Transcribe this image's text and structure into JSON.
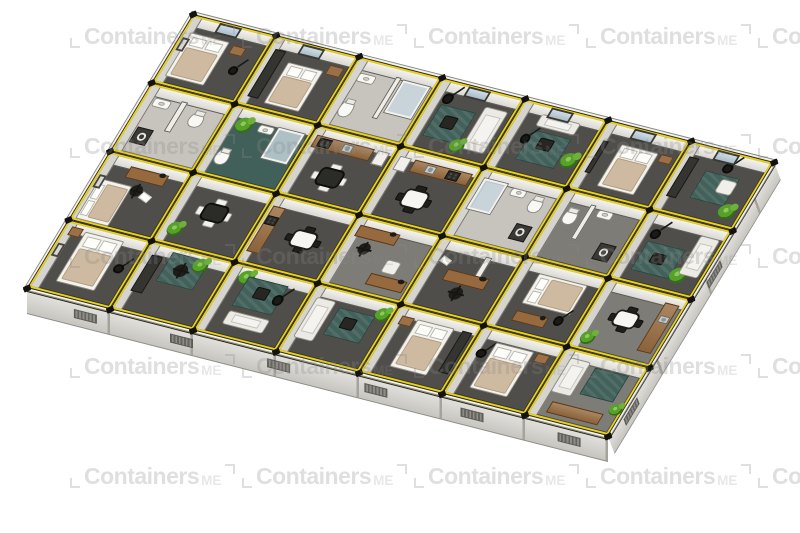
{
  "watermark": {
    "text": "Containers",
    "suffix": "ME"
  },
  "watermark_grid": {
    "cols": 5,
    "rows": 5,
    "x0": 70,
    "y0": 24,
    "dx": 172,
    "dy": 110
  },
  "palette": {
    "frame_yellow": "#e9d116",
    "edge_black": "#23221d",
    "wall_white": "#f2f1ed",
    "floor_dark": "#4f4e4a",
    "floor_mid": "#7e7c77",
    "floor_light": "#c7c4bd",
    "floor_teal": "#41605a",
    "wood": "#96693e",
    "plant_green": "#57a02c",
    "bed_beige": "#cdbaa0",
    "watermark_gray": "#e3e3e3"
  },
  "building": {
    "cols": 7,
    "rows": 4,
    "cell_w": 94,
    "cell_h": 80,
    "transform": "matrix(0.883,0.225,-0.519,0.856,193,14)",
    "facade_sw": {
      "transform": "matrix(0.883,0.225,0,1,27,288)",
      "w": 658,
      "h": 26,
      "vents": 6
    },
    "facade_se": {
      "transform": "matrix(0.519,-0.856,0.35,0.94,608,436)",
      "w": 320,
      "h": 19,
      "vents": 2
    },
    "cells": [
      {
        "col": 0,
        "row": 0,
        "floor": "dark",
        "window": true,
        "frame": true,
        "furn": [
          [
            "bed",
            10,
            24,
            46,
            64
          ],
          [
            "nightstand",
            62,
            26,
            16,
            13
          ],
          [
            "lamp",
            72,
            52,
            11,
            13
          ]
        ]
      },
      {
        "col": 1,
        "row": 0,
        "floor": "dark",
        "window": true,
        "furn": [
          [
            "wardrobe",
            8,
            18,
            13,
            68
          ],
          [
            "bed",
            30,
            30,
            42,
            60
          ],
          [
            "cabinet",
            76,
            20,
            17,
            14
          ]
        ]
      },
      {
        "col": 2,
        "row": 0,
        "floor": "light",
        "furn": [
          [
            "wall",
            52,
            14,
            7,
            60
          ],
          [
            "shower",
            62,
            16,
            32,
            46
          ],
          [
            "sink",
            12,
            20,
            20,
            12
          ],
          [
            "toilet",
            12,
            58,
            16,
            24
          ]
        ]
      },
      {
        "col": 3,
        "row": 0,
        "floor": "dark",
        "window": true,
        "furn": [
          [
            "rug",
            16,
            34,
            42,
            46
          ],
          [
            "sofa",
            64,
            22,
            28,
            62
          ],
          [
            "coffee",
            28,
            46,
            16,
            18
          ],
          [
            "lamp",
            14,
            18,
            12,
            14
          ],
          [
            "plant",
            50,
            72,
            17,
            19
          ]
        ]
      },
      {
        "col": 4,
        "row": 0,
        "floor": "dark",
        "window": true,
        "furn": [
          [
            "sofa",
            28,
            14,
            46,
            17
          ],
          [
            "rug",
            28,
            36,
            46,
            44
          ],
          [
            "coffee",
            42,
            44,
            16,
            16
          ],
          [
            "plant",
            76,
            54,
            19,
            21
          ],
          [
            "lamp",
            20,
            44,
            11,
            13
          ]
        ]
      },
      {
        "col": 5,
        "row": 0,
        "floor": "dark",
        "window": true,
        "furn": [
          [
            "tv",
            9,
            28,
            6,
            46
          ],
          [
            "bed",
            30,
            26,
            44,
            62
          ],
          [
            "nightstand",
            78,
            26,
            15,
            12
          ]
        ]
      },
      {
        "col": 6,
        "row": 0,
        "floor": "dark",
        "window": true,
        "furn": [
          [
            "wardrobe",
            8,
            20,
            12,
            58
          ],
          [
            "rug",
            34,
            32,
            42,
            40
          ],
          [
            "chairw",
            56,
            38,
            20,
            20
          ],
          [
            "plant",
            72,
            68,
            19,
            21
          ],
          [
            "lamp",
            50,
            16,
            12,
            14
          ]
        ]
      },
      {
        "col": 0,
        "row": 1,
        "floor": "light",
        "furn": [
          [
            "sink",
            14,
            18,
            20,
            12
          ],
          [
            "toilet",
            62,
            22,
            17,
            22
          ],
          [
            "washer",
            14,
            60,
            19,
            23
          ],
          [
            "wall",
            44,
            14,
            7,
            44
          ]
        ]
      },
      {
        "col": 1,
        "row": 1,
        "floor": "teal",
        "furn": [
          [
            "plant",
            14,
            14,
            19,
            21
          ],
          [
            "shower",
            62,
            16,
            31,
            44
          ],
          [
            "sink",
            40,
            18,
            18,
            11
          ],
          [
            "toilet",
            13,
            60,
            16,
            22
          ]
        ]
      },
      {
        "col": 2,
        "row": 1,
        "floor": "dark",
        "furn": [
          [
            "counter",
            6,
            13,
            70,
            17
          ],
          [
            "stove",
            12,
            15,
            15,
            13
          ],
          [
            "sinks",
            40,
            15,
            12,
            11
          ],
          [
            "fridge",
            80,
            13,
            14,
            20
          ],
          [
            "dining",
            26,
            44,
            40,
            38,
            "inv"
          ]
        ]
      },
      {
        "col": 3,
        "row": 1,
        "floor": "dark",
        "furn": [
          [
            "counter",
            24,
            13,
            70,
            17
          ],
          [
            "stove",
            66,
            15,
            15,
            13
          ],
          [
            "sinks",
            40,
            15,
            12,
            11
          ],
          [
            "fridge",
            6,
            13,
            14,
            20
          ],
          [
            "dining",
            28,
            44,
            40,
            38
          ]
        ]
      },
      {
        "col": 4,
        "row": 1,
        "floor": "light",
        "furn": [
          [
            "shower",
            8,
            14,
            28,
            44
          ],
          [
            "sink",
            44,
            16,
            18,
            11
          ],
          [
            "toilet",
            70,
            20,
            16,
            22
          ],
          [
            "washer",
            70,
            60,
            19,
            22
          ]
        ]
      },
      {
        "col": 5,
        "row": 1,
        "floor": "mid",
        "furn": [
          [
            "wall",
            36,
            12,
            7,
            50
          ],
          [
            "toilet",
            14,
            24,
            16,
            22
          ],
          [
            "sink",
            48,
            16,
            18,
            11
          ],
          [
            "washer",
            70,
            58,
            19,
            23
          ]
        ]
      },
      {
        "col": 6,
        "row": 1,
        "floor": "dark",
        "furn": [
          [
            "rug",
            18,
            40,
            46,
            42
          ],
          [
            "coffee",
            32,
            52,
            16,
            16
          ],
          [
            "plant",
            62,
            64,
            19,
            21
          ],
          [
            "sofa",
            70,
            16,
            24,
            56
          ],
          [
            "lamp",
            16,
            22,
            12,
            14
          ]
        ]
      },
      {
        "col": 0,
        "row": 2,
        "floor": "dark",
        "frame": true,
        "furn": [
          [
            "desk",
            32,
            13,
            46,
            16
          ],
          [
            "officechair",
            46,
            34,
            14,
            16
          ],
          [
            "paper",
            60,
            42,
            13,
            10
          ],
          [
            "bed",
            6,
            38,
            40,
            58,
            "h"
          ]
        ]
      },
      {
        "col": 1,
        "row": 2,
        "floor": "dark",
        "furn": [
          [
            "dining",
            28,
            26,
            40,
            38,
            "inv"
          ],
          [
            "plant",
            8,
            68,
            18,
            20
          ]
        ]
      },
      {
        "col": 2,
        "row": 2,
        "floor": "dark",
        "furn": [
          [
            "counter",
            5,
            16,
            15,
            66
          ],
          [
            "stove",
            6,
            30,
            13,
            13
          ],
          [
            "dining",
            38,
            32,
            40,
            36
          ]
        ]
      },
      {
        "col": 3,
        "row": 2,
        "floor": "mid",
        "furn": [
          [
            "desk",
            8,
            13,
            48,
            16
          ],
          [
            "officechair",
            20,
            34,
            14,
            16
          ],
          [
            "desk",
            50,
            70,
            44,
            16
          ],
          [
            "chairw",
            58,
            48,
            18,
            18
          ]
        ]
      },
      {
        "col": 4,
        "row": 2,
        "floor": "dark",
        "furn": [
          [
            "wall",
            60,
            12,
            7,
            40
          ],
          [
            "desk",
            28,
            40,
            50,
            16
          ],
          [
            "officechair",
            44,
            60,
            15,
            17
          ],
          [
            "paper",
            14,
            26,
            12,
            9
          ]
        ]
      },
      {
        "col": 5,
        "row": 2,
        "floor": "dark",
        "furn": [
          [
            "bed",
            26,
            16,
            58,
            44,
            "h"
          ],
          [
            "desk",
            26,
            70,
            38,
            15
          ],
          [
            "lamp",
            70,
            64,
            11,
            13
          ]
        ]
      },
      {
        "col": 6,
        "row": 2,
        "floor": "mid",
        "furn": [
          [
            "counter",
            76,
            13,
            17,
            70
          ],
          [
            "sinks",
            79,
            30,
            11,
            10
          ],
          [
            "dining",
            26,
            30,
            38,
            34
          ],
          [
            "plant",
            8,
            72,
            17,
            19
          ]
        ]
      },
      {
        "col": 0,
        "row": 3,
        "floor": "dark",
        "frame": true,
        "furn": [
          [
            "nightstand",
            8,
            8,
            14,
            12
          ],
          [
            "bed",
            26,
            10,
            46,
            72
          ],
          [
            "lamp",
            78,
            40,
            11,
            13
          ]
        ]
      },
      {
        "col": 1,
        "row": 3,
        "floor": "dark",
        "furn": [
          [
            "wardrobe",
            10,
            18,
            13,
            52
          ],
          [
            "rug",
            30,
            8,
            44,
            42
          ],
          [
            "officechair",
            42,
            20,
            15,
            17
          ],
          [
            "plant",
            58,
            6,
            18,
            20
          ]
        ]
      },
      {
        "col": 2,
        "row": 3,
        "floor": "dark",
        "furn": [
          [
            "plant",
            14,
            6,
            18,
            20
          ],
          [
            "rug",
            24,
            14,
            48,
            42
          ],
          [
            "coffee",
            40,
            24,
            16,
            16
          ],
          [
            "lamp",
            64,
            28,
            12,
            14
          ],
          [
            "sofa",
            26,
            62,
            48,
            20
          ]
        ]
      },
      {
        "col": 3,
        "row": 3,
        "floor": "dark",
        "furn": [
          [
            "sofa",
            8,
            18,
            24,
            58
          ],
          [
            "rug",
            38,
            24,
            44,
            40
          ],
          [
            "coffee",
            50,
            34,
            16,
            16
          ],
          [
            "plant",
            80,
            10,
            17,
            19
          ]
        ]
      },
      {
        "col": 4,
        "row": 3,
        "floor": "dark",
        "furn": [
          [
            "nightstand",
            10,
            14,
            14,
            12
          ],
          [
            "bed",
            28,
            14,
            44,
            68
          ],
          [
            "wardrobe",
            82,
            14,
            12,
            60
          ]
        ]
      },
      {
        "col": 5,
        "row": 3,
        "floor": "dark",
        "furn": [
          [
            "lamp",
            10,
            30,
            11,
            13
          ],
          [
            "bed",
            24,
            18,
            46,
            66
          ],
          [
            "nightstand",
            74,
            18,
            15,
            12
          ]
        ]
      },
      {
        "col": 6,
        "row": 3,
        "floor": "mid",
        "furn": [
          [
            "sofa",
            12,
            12,
            24,
            50
          ],
          [
            "rug",
            44,
            18,
            40,
            38
          ],
          [
            "counter",
            20,
            74,
            62,
            16
          ],
          [
            "plant",
            84,
            56,
            15,
            17
          ]
        ]
      }
    ]
  }
}
